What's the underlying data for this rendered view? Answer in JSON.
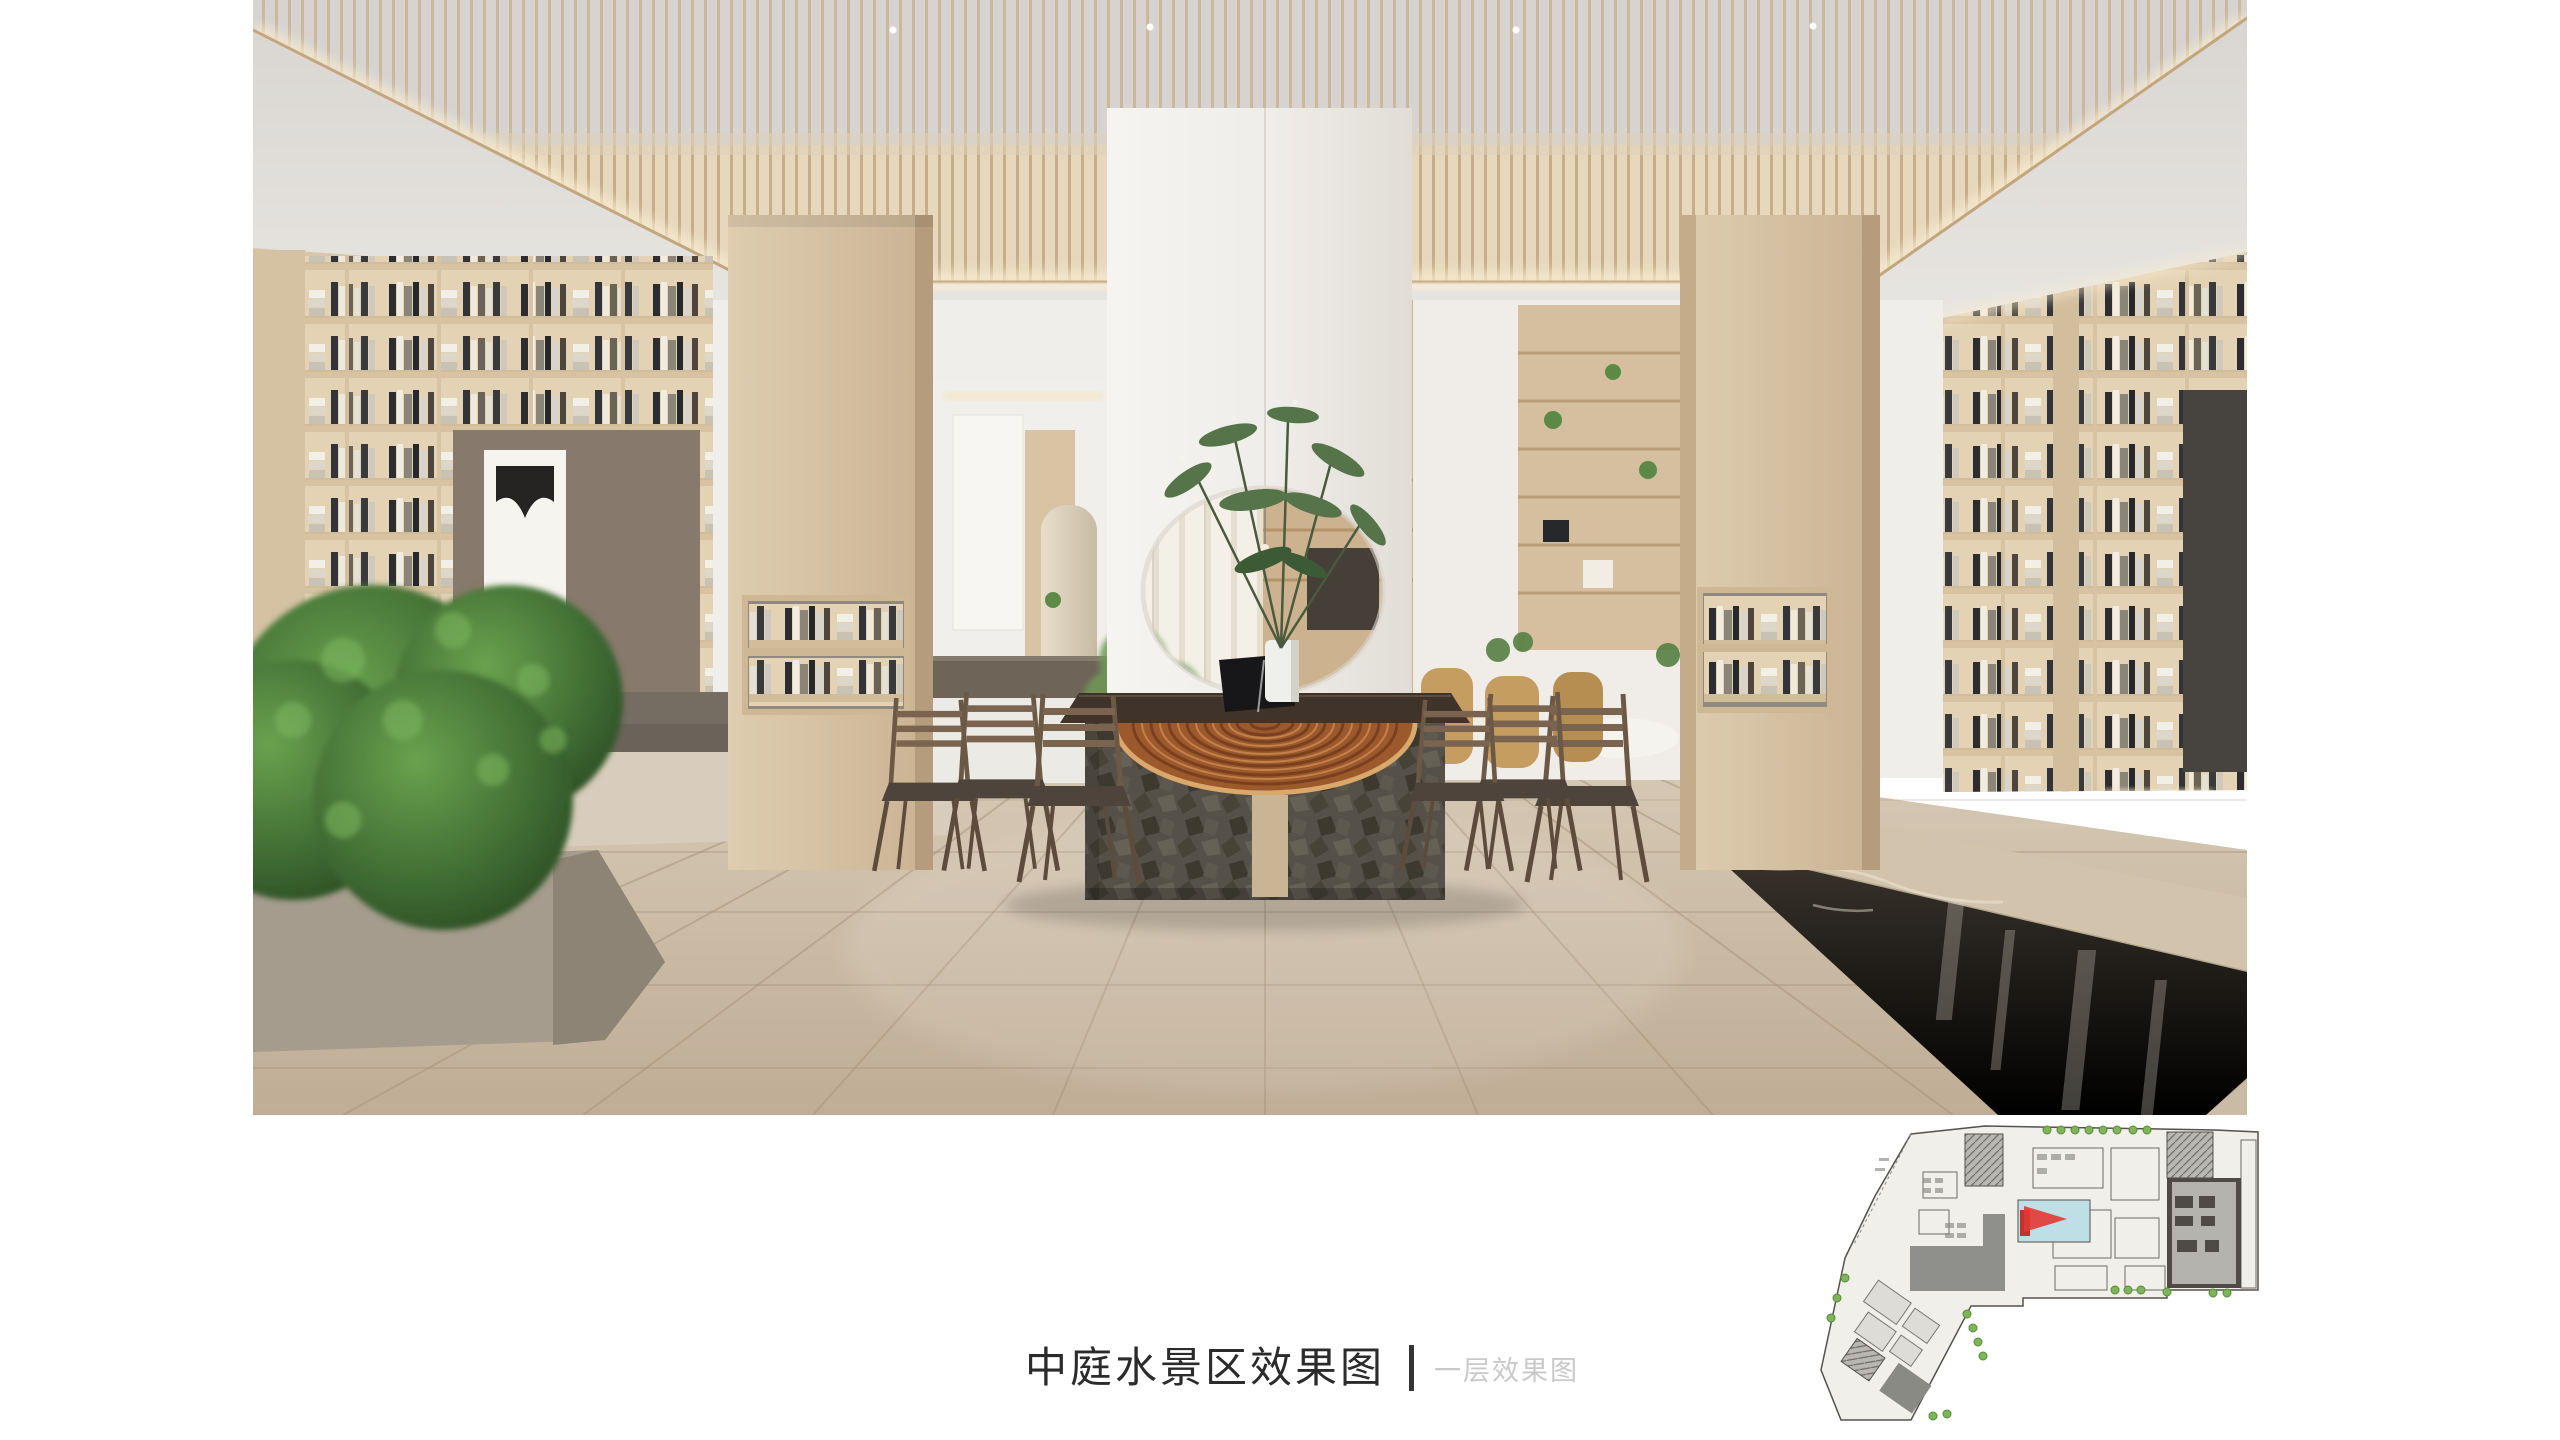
{
  "slide": {
    "background": "#ffffff"
  },
  "caption": {
    "title": "中庭水景区效果图",
    "subtitle": "一层效果图",
    "title_color": "#2b2b2b",
    "subtitle_color": "#c9c9c9",
    "divider_color": "#343434"
  },
  "rendering": {
    "label": "atrium-water-feature-interior-rendering",
    "palette": {
      "wood_light": "#dccaaf",
      "wood_slat": "#e7d8bd",
      "travertine_floor": "#cbbda8",
      "white_wall": "#f2f0ec",
      "ceiling_gray": "#dad7d2",
      "stone_base": "#555148",
      "water_dark": "#322d27",
      "foliage_green": "#47713a",
      "tree_ring_wood": "#9c5a2c",
      "cushion_gray": "#6e665c"
    }
  },
  "floor_plan": {
    "label": "first-floor-key-plan",
    "paper_color": "#f0efea",
    "outline_color": "#55524d",
    "room_gray": "#8f8f8b",
    "marker_color": "#e23834",
    "pool_color": "#bfdfe6",
    "landscape_green": "#7fb559"
  }
}
